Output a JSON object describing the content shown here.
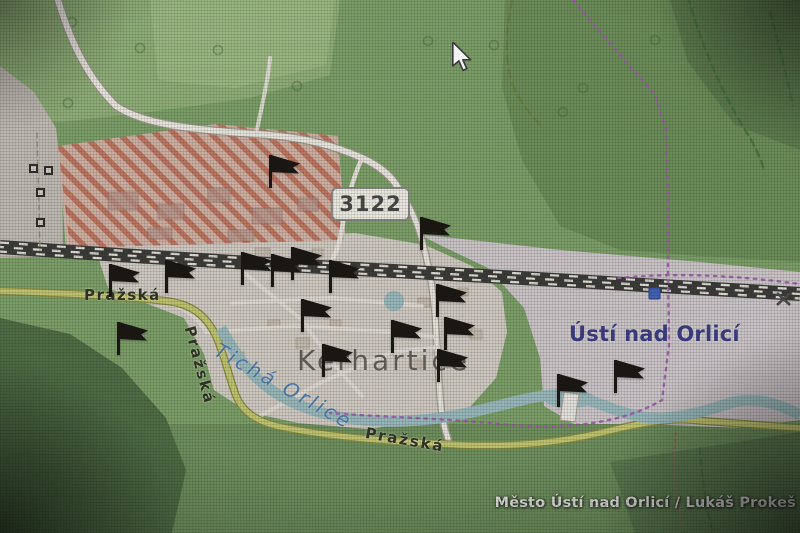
{
  "window": {
    "width": 800,
    "height": 533,
    "kind": "photographed map screen"
  },
  "map": {
    "road_badge": {
      "text": "3122"
    },
    "labels": {
      "street_prazska_west": "Pražská",
      "street_prazska_hill": "Pražská",
      "street_prazska_south": "Pražská",
      "river": "Tichá Orlice",
      "village": "Kerhartice",
      "town": "Ústí nad Orlicí"
    },
    "credit": "Město Ústí nad Orlicí / Lukáš Prokeš",
    "markers": {
      "type": "flag",
      "positions": [
        {
          "x": 270,
          "y": 188
        },
        {
          "x": 421,
          "y": 250
        },
        {
          "x": 110,
          "y": 297
        },
        {
          "x": 166,
          "y": 293
        },
        {
          "x": 118,
          "y": 355
        },
        {
          "x": 242,
          "y": 285
        },
        {
          "x": 272,
          "y": 287
        },
        {
          "x": 292,
          "y": 280
        },
        {
          "x": 330,
          "y": 293
        },
        {
          "x": 302,
          "y": 332
        },
        {
          "x": 437,
          "y": 317
        },
        {
          "x": 445,
          "y": 350
        },
        {
          "x": 438,
          "y": 382
        },
        {
          "x": 392,
          "y": 353
        },
        {
          "x": 323,
          "y": 377
        },
        {
          "x": 558,
          "y": 407
        },
        {
          "x": 615,
          "y": 393
        }
      ]
    },
    "colors": {
      "flag": "#17130f",
      "water": "#9cc0c4",
      "water_label": "#4d80b8",
      "road_tertiary": "#c9cd6b",
      "road_tertiary_casing": "#8e923e",
      "residential": "#d8d1ca",
      "construction_stripe": "#c96a52",
      "railway": "#3a3a38",
      "boundary": "#a85cb8",
      "town_label": "#3b3b90",
      "village_label": "#5f5a57",
      "street_label": "#2e3320",
      "badge_bg": "#f7f3eb",
      "badge_border": "#8d8d8d",
      "badge_text": "#474747",
      "credit_text": "#ededeb",
      "station": "#3f63c8"
    },
    "cursor": {
      "x": 450,
      "y": 42
    }
  }
}
